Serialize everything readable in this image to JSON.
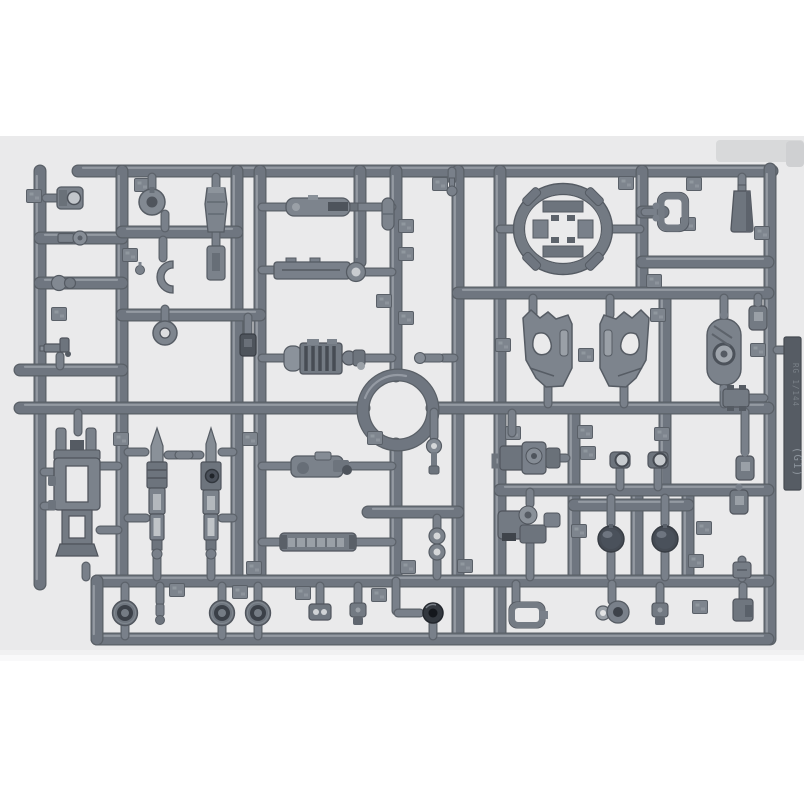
{
  "scene": {
    "kind": "photo of a plastic model kit parts runner (sprue)",
    "page_bg": "#ffffff",
    "photo_bg": "#eaeaeb",
    "photo_top": 136,
    "photo_bottom": 656,
    "patches": [
      [
        716,
        140,
        88,
        22
      ],
      [
        786,
        141,
        18,
        26
      ]
    ]
  },
  "palette": {
    "runner_base": "#6f7680",
    "runner_dark": "#5a6067",
    "runner_hi": "#9ba1a9",
    "pin_base": "#79808a",
    "pin_dark": "#5c626a",
    "gate_fill": "#7e858e",
    "tag_fill": "#565c64",
    "tag_text": "#8a9199"
  },
  "tag": {
    "x": 784,
    "y": 337,
    "w": 17,
    "h": 153,
    "line1": "RG 1/144",
    "line2": "(G1)"
  },
  "sprue": {
    "ring": {
      "cx": 398,
      "cy": 410,
      "r": 35
    },
    "runners": [
      [
        78,
        171,
        772,
        171
      ],
      [
        40,
        171,
        40,
        584
      ],
      [
        122,
        171,
        122,
        581
      ],
      [
        237,
        171,
        237,
        581
      ],
      [
        260,
        171,
        260,
        581
      ],
      [
        360,
        171,
        360,
        262
      ],
      [
        396,
        171,
        396,
        376
      ],
      [
        396,
        444,
        396,
        581
      ],
      [
        458,
        171,
        458,
        639
      ],
      [
        500,
        171,
        500,
        639
      ],
      [
        574,
        408,
        574,
        581
      ],
      [
        642,
        171,
        642,
        293
      ],
      [
        665,
        293,
        665,
        490
      ],
      [
        637,
        490,
        637,
        581
      ],
      [
        688,
        490,
        688,
        581
      ],
      [
        770,
        169,
        770,
        639
      ],
      [
        40,
        238,
        122,
        238
      ],
      [
        40,
        283,
        122,
        283
      ],
      [
        20,
        370,
        122,
        370
      ],
      [
        20,
        408,
        364,
        408
      ],
      [
        432,
        408,
        768,
        408
      ],
      [
        122,
        232,
        237,
        232
      ],
      [
        122,
        315,
        260,
        315
      ],
      [
        458,
        293,
        768,
        293
      ],
      [
        642,
        262,
        768,
        262
      ],
      [
        642,
        212,
        663,
        212
      ],
      [
        500,
        490,
        768,
        490
      ],
      [
        574,
        505,
        688,
        505
      ],
      [
        368,
        512,
        458,
        512
      ],
      [
        97,
        581,
        768,
        581
      ],
      [
        97,
        639,
        768,
        639
      ],
      [
        97,
        581,
        97,
        639
      ]
    ],
    "pins": [
      [
        46,
        198,
        58,
        198
      ],
      [
        60,
        356,
        60,
        366
      ],
      [
        78,
        413,
        78,
        432
      ],
      [
        100,
        466,
        118,
        466
      ],
      [
        100,
        530,
        118,
        530
      ],
      [
        44,
        472,
        54,
        472
      ],
      [
        44,
        506,
        54,
        506
      ],
      [
        86,
        566,
        86,
        577
      ],
      [
        152,
        177,
        152,
        190
      ],
      [
        165,
        214,
        165,
        228
      ],
      [
        216,
        177,
        216,
        188
      ],
      [
        163,
        240,
        163,
        258
      ],
      [
        216,
        232,
        216,
        246
      ],
      [
        165,
        309,
        165,
        320
      ],
      [
        248,
        317,
        248,
        333
      ],
      [
        128,
        452,
        145,
        452
      ],
      [
        128,
        518,
        146,
        518
      ],
      [
        168,
        455,
        177,
        455
      ],
      [
        191,
        455,
        200,
        455
      ],
      [
        222,
        518,
        233,
        518
      ],
      [
        222,
        452,
        233,
        452
      ],
      [
        157,
        557,
        157,
        577
      ],
      [
        211,
        556,
        211,
        577
      ],
      [
        262,
        207,
        288,
        207
      ],
      [
        357,
        207,
        392,
        207
      ],
      [
        262,
        270,
        276,
        270
      ],
      [
        355,
        272,
        392,
        272
      ],
      [
        262,
        358,
        286,
        358
      ],
      [
        364,
        358,
        392,
        358
      ],
      [
        262,
        466,
        291,
        466
      ],
      [
        351,
        466,
        392,
        466
      ],
      [
        262,
        542,
        281,
        542
      ],
      [
        355,
        542,
        392,
        542
      ],
      [
        452,
        171,
        452,
        180
      ],
      [
        500,
        229,
        518,
        229
      ],
      [
        608,
        229,
        640,
        229
      ],
      [
        645,
        212,
        658,
        212
      ],
      [
        742,
        177,
        742,
        192
      ],
      [
        533,
        298,
        533,
        315
      ],
      [
        610,
        298,
        610,
        315
      ],
      [
        548,
        384,
        548,
        404
      ],
      [
        624,
        384,
        624,
        404
      ],
      [
        724,
        298,
        724,
        317
      ],
      [
        724,
        387,
        724,
        404
      ],
      [
        512,
        413,
        512,
        433
      ],
      [
        556,
        458,
        566,
        458
      ],
      [
        530,
        492,
        530,
        504
      ],
      [
        530,
        544,
        530,
        577
      ],
      [
        620,
        469,
        620,
        487
      ],
      [
        658,
        469,
        658,
        487
      ],
      [
        611,
        498,
        611,
        524
      ],
      [
        665,
        498,
        665,
        524
      ],
      [
        611,
        553,
        611,
        577
      ],
      [
        665,
        553,
        665,
        577
      ],
      [
        758,
        297,
        758,
        309
      ],
      [
        749,
        398,
        764,
        398
      ],
      [
        745,
        412,
        745,
        452
      ],
      [
        742,
        560,
        742,
        578
      ],
      [
        125,
        586,
        125,
        601
      ],
      [
        125,
        625,
        125,
        636
      ],
      [
        222,
        586,
        222,
        601
      ],
      [
        222,
        625,
        222,
        636
      ],
      [
        258,
        586,
        258,
        601
      ],
      [
        258,
        625,
        258,
        636
      ],
      [
        160,
        586,
        160,
        602
      ],
      [
        320,
        586,
        320,
        603
      ],
      [
        358,
        586,
        358,
        602
      ],
      [
        516,
        584,
        516,
        604
      ],
      [
        612,
        584,
        612,
        601
      ],
      [
        660,
        586,
        660,
        602
      ],
      [
        743,
        586,
        743,
        600
      ],
      [
        433,
        624,
        433,
        636
      ],
      [
        434,
        412,
        434,
        437
      ],
      [
        437,
        518,
        437,
        529
      ],
      [
        437,
        559,
        437,
        576
      ],
      [
        396,
        581,
        396,
        611
      ],
      [
        398,
        613,
        420,
        613
      ],
      [
        443,
        358,
        454,
        358
      ],
      [
        777,
        350,
        786,
        350
      ]
    ],
    "gates": [
      [
        34,
        196
      ],
      [
        142,
        185
      ],
      [
        440,
        184
      ],
      [
        626,
        183
      ],
      [
        694,
        184
      ],
      [
        762,
        233
      ],
      [
        688,
        224
      ],
      [
        654,
        281
      ],
      [
        130,
        255
      ],
      [
        59,
        314
      ],
      [
        121,
        439
      ],
      [
        250,
        439
      ],
      [
        375,
        438
      ],
      [
        406,
        226
      ],
      [
        406,
        254
      ],
      [
        384,
        301
      ],
      [
        406,
        318
      ],
      [
        503,
        345
      ],
      [
        586,
        355
      ],
      [
        658,
        315
      ],
      [
        758,
        350
      ],
      [
        513,
        433
      ],
      [
        585,
        432
      ],
      [
        662,
        434
      ],
      [
        588,
        453
      ],
      [
        704,
        528
      ],
      [
        579,
        531
      ],
      [
        696,
        561
      ],
      [
        177,
        590
      ],
      [
        240,
        592
      ],
      [
        303,
        593
      ],
      [
        254,
        568
      ],
      [
        465,
        566
      ],
      [
        379,
        595
      ],
      [
        700,
        607
      ],
      [
        408,
        567
      ]
    ]
  },
  "parts": [
    {
      "t": "socket",
      "x": 70,
      "y": 198
    },
    {
      "t": "balllink",
      "x": 72,
      "y": 238
    },
    {
      "t": "ballpair",
      "x": 64,
      "y": 283
    },
    {
      "t": "lgun",
      "x": 60,
      "y": 348
    },
    {
      "t": "bigweapon",
      "x": 78,
      "y": 498
    },
    {
      "t": "donut",
      "x": 152,
      "y": 202
    },
    {
      "t": "shoe",
      "x": 216,
      "y": 210
    },
    {
      "t": "ministub",
      "x": 140,
      "y": 270
    },
    {
      "t": "upart",
      "x": 163,
      "y": 277
    },
    {
      "t": "flatplate",
      "x": 216,
      "y": 263
    },
    {
      "t": "torus",
      "x": 165,
      "y": 333
    },
    {
      "t": "darkbit",
      "x": 248,
      "y": 345
    },
    {
      "t": "rifleA",
      "x": 157,
      "y": 492
    },
    {
      "t": "rifleB",
      "x": 211,
      "y": 492
    },
    {
      "t": "riflelink",
      "x": 184,
      "y": 455
    },
    {
      "t": "missile",
      "x": 322,
      "y": 207
    },
    {
      "t": "longbar",
      "x": 316,
      "y": 270
    },
    {
      "t": "tank",
      "x": 325,
      "y": 358
    },
    {
      "t": "moto",
      "x": 321,
      "y": 466
    },
    {
      "t": "stripebar",
      "x": 318,
      "y": 542
    },
    {
      "t": "capsule",
      "x": 388,
      "y": 214
    },
    {
      "t": "smallpin",
      "x": 452,
      "y": 186
    },
    {
      "t": "tbar",
      "x": 432,
      "y": 358
    },
    {
      "t": "balltop",
      "x": 434,
      "y": 456
    },
    {
      "t": "dblring",
      "x": 437,
      "y": 544
    },
    {
      "t": "minilens",
      "x": 433,
      "y": 613
    },
    {
      "t": "ovalring",
      "x": 563,
      "y": 229
    },
    {
      "t": "bracketsq",
      "x": 673,
      "y": 212
    },
    {
      "t": "trapezoid",
      "x": 742,
      "y": 211
    },
    {
      "t": "knee",
      "x": 548,
      "y": 348
    },
    {
      "t": "knee",
      "x": 624,
      "y": 348,
      "mx": -1
    },
    {
      "t": "ovalflat",
      "x": 724,
      "y": 352
    },
    {
      "t": "backpack",
      "x": 530,
      "y": 458
    },
    {
      "t": "backpack2",
      "x": 530,
      "y": 525
    },
    {
      "t": "eyepart",
      "x": 620,
      "y": 460
    },
    {
      "t": "eyepart",
      "x": 658,
      "y": 460
    },
    {
      "t": "dome",
      "x": 611,
      "y": 539
    },
    {
      "t": "dome",
      "x": 665,
      "y": 539
    },
    {
      "t": "sbox",
      "x": 758,
      "y": 318
    },
    {
      "t": "hbracket",
      "x": 736,
      "y": 398
    },
    {
      "t": "sbox",
      "x": 745,
      "y": 468
    },
    {
      "t": "sbox",
      "x": 739,
      "y": 502
    },
    {
      "t": "smallbox",
      "x": 742,
      "y": 570
    },
    {
      "t": "lens",
      "x": 125,
      "y": 613
    },
    {
      "t": "tinybit",
      "x": 160,
      "y": 613
    },
    {
      "t": "lens",
      "x": 222,
      "y": 613
    },
    {
      "t": "lens",
      "x": 258,
      "y": 613
    },
    {
      "t": "eyes2",
      "x": 320,
      "y": 612
    },
    {
      "t": "robobit",
      "x": 358,
      "y": 613
    },
    {
      "t": "buckle",
      "x": 527,
      "y": 615
    },
    {
      "t": "ringflat",
      "x": 612,
      "y": 612
    },
    {
      "t": "robobit",
      "x": 660,
      "y": 613
    },
    {
      "t": "cornerbit",
      "x": 743,
      "y": 610
    }
  ]
}
